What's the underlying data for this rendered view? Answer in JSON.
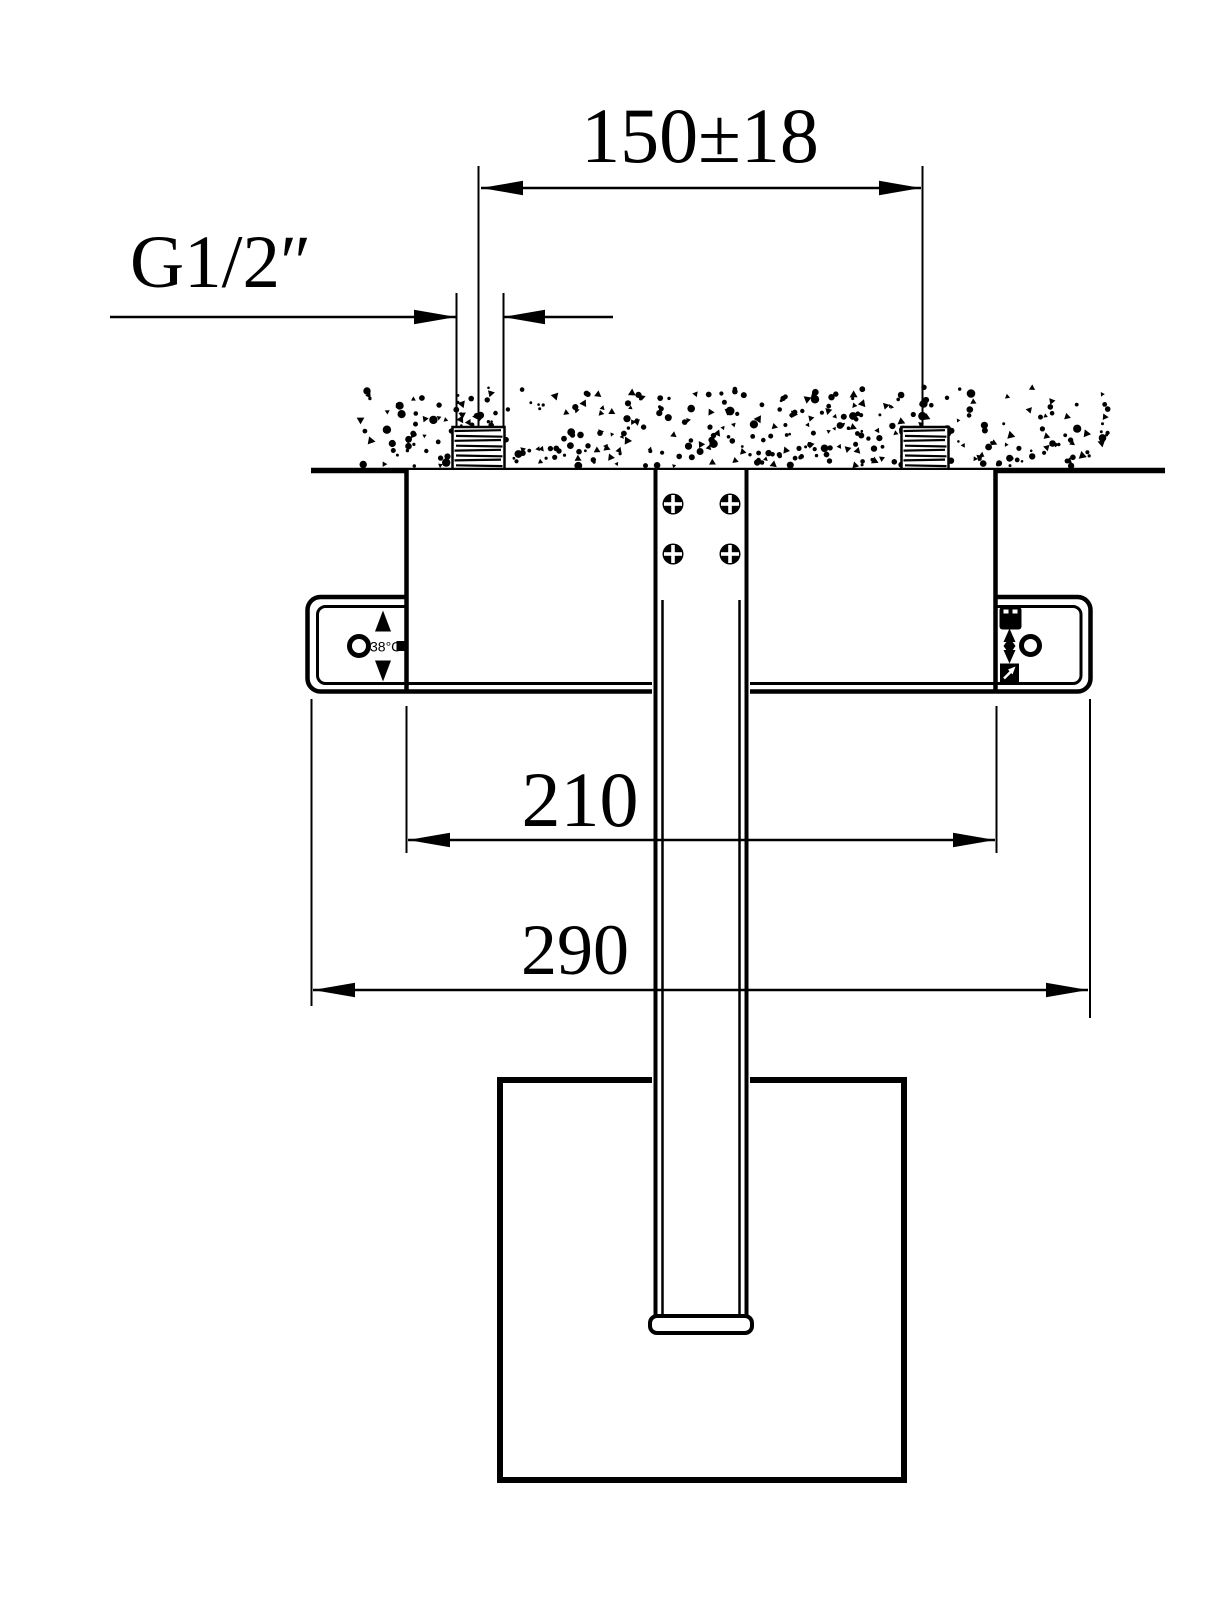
{
  "meta": {
    "drawing_kind": "thermostatic-shower-valve-installation-diagram",
    "colors": {
      "line": "#000000",
      "background": "#ffffff"
    }
  },
  "labels": {
    "hole_spacing": "150±18",
    "thread_size": "G1/2″",
    "valve_body_width": "210",
    "trim_plate_width": "290",
    "temperature": "38°C"
  }
}
